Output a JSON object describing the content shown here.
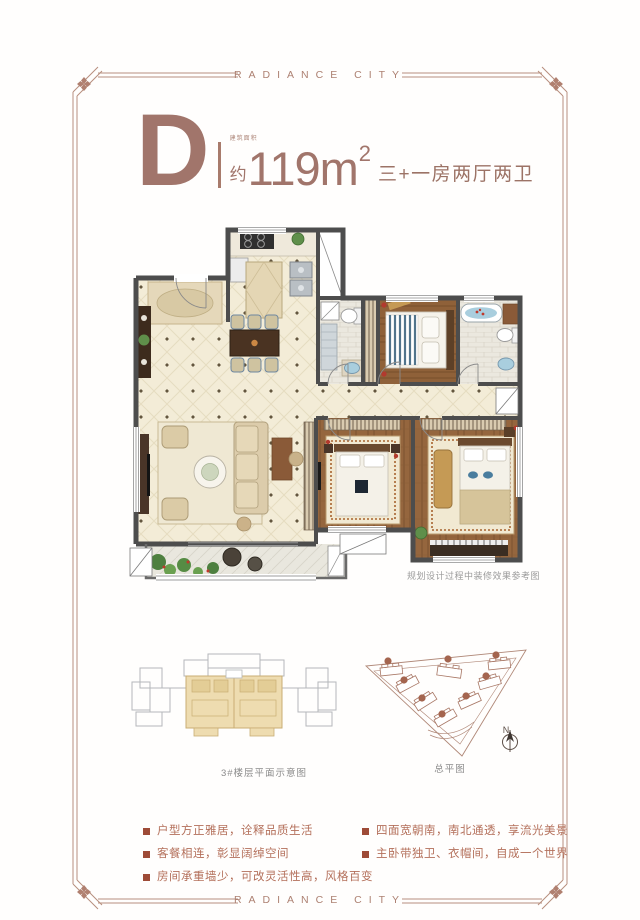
{
  "brand": {
    "top": "RADIANCE CITY",
    "bottom": "RADIANCE CITY"
  },
  "title": {
    "unit": "D",
    "area_note": "建筑面积",
    "approx": "约",
    "area": "119m",
    "area_sup": "2",
    "layout": "三+一房两厅两卫"
  },
  "floor_plan": {
    "caption": "规划设计过程中装修效果参考图"
  },
  "diagrams": {
    "building_label": "3#楼层平面示意图",
    "site_label": "总平图",
    "north": "N"
  },
  "features": {
    "left": [
      "户型方正雅居，诠释品质生活",
      "客餐相连，彰显阔绰空间",
      "房间承重墙少，可改灵活性高，风格百变"
    ],
    "right": [
      "四面宽朝南，南北通透，享流光美景",
      "主卧带独卫、衣帽间，自成一个世界"
    ]
  },
  "colors": {
    "accent": "#a1756b",
    "frame": "#b08070",
    "bullet_square": "#9e4b37",
    "feature_text": "#b4705b",
    "wall": "#4d4d4d",
    "tile_floor": "#f3ecd7",
    "wood_floor": "#95663e",
    "highlight_unit": "#eedcb0"
  }
}
